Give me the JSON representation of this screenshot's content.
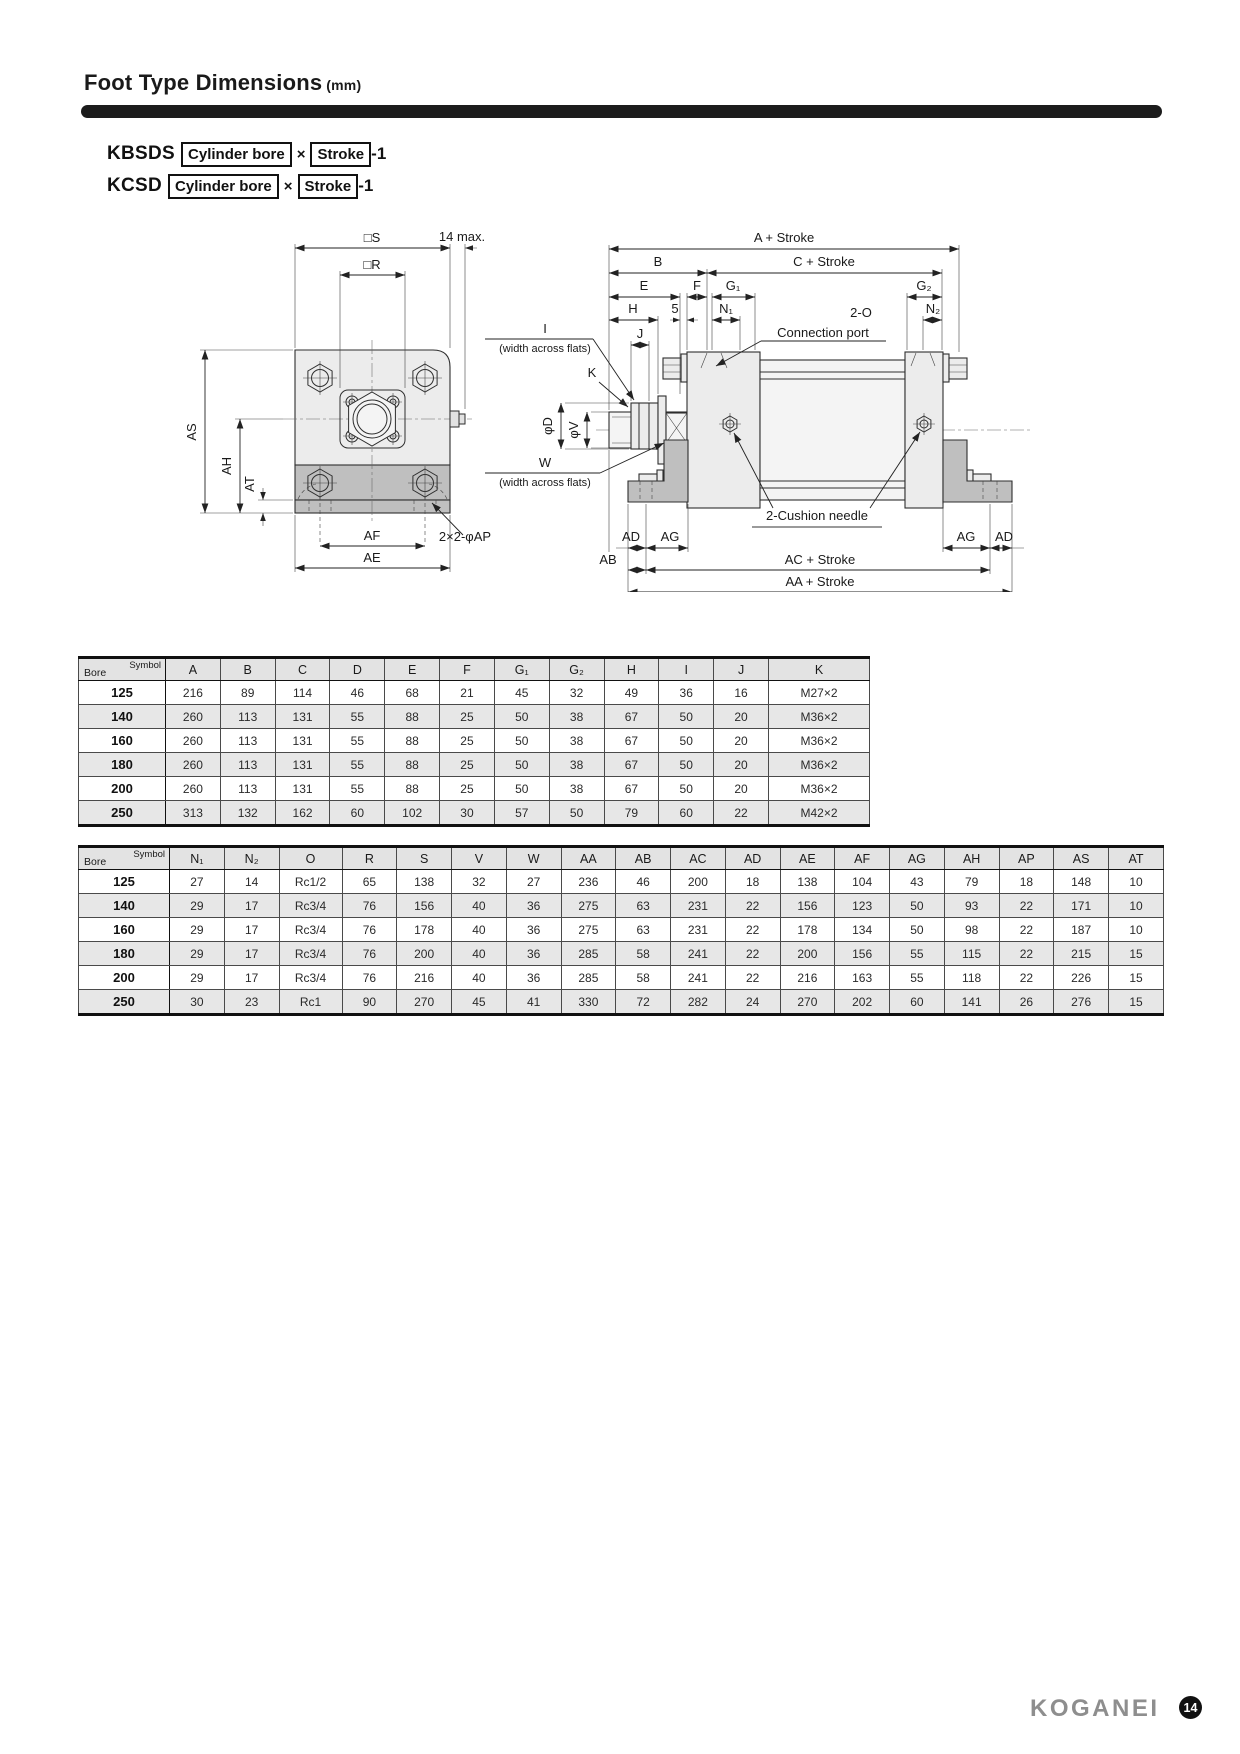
{
  "page": {
    "title": "Foot Type Dimensions",
    "unit": "(mm)"
  },
  "colors": {
    "accent_black": "#1c1c1c",
    "logo_gray": "#8e8e8e",
    "table_shade": "#e7e7e7"
  },
  "models": [
    {
      "code": "KBSDS",
      "box1": "Cylinder bore",
      "times": "×",
      "box2": "Stroke",
      "suffix": "-1"
    },
    {
      "code": "KCSD",
      "box1": "Cylinder bore",
      "times": "×",
      "box2": "Stroke",
      "suffix": "-1"
    }
  ],
  "drawing": {
    "labels": {
      "sq_s": "□S",
      "sq_r": "□R",
      "max14": "14 max.",
      "as": "AS",
      "ah": "AH",
      "at": "AT",
      "af": "AF",
      "ae": "AE",
      "ap": "2×2-φAP",
      "a_stroke": "A + Stroke",
      "b": "B",
      "c_stroke": "C + Stroke",
      "e": "E",
      "f": "F",
      "g1": "G₁",
      "g2": "G₂",
      "h": "H",
      "five": "5",
      "n1": "N₁",
      "n2": "N₂",
      "j": "J",
      "i": "I",
      "waf1": "(width across flats)",
      "k": "K",
      "phi_d": "φD",
      "phi_v": "φV",
      "w": "W",
      "waf2": "(width across flats)",
      "two_o": "2-O",
      "conn_port": "Connection port",
      "cushion": "2-Cushion needle",
      "ad_l": "AD",
      "ag_l": "AG",
      "ab": "AB",
      "ac_stroke": "AC + Stroke",
      "aa_stroke": "AA + Stroke",
      "ag_r": "AG",
      "ad_r": "AD"
    }
  },
  "table1": {
    "corner": {
      "top": "Symbol",
      "bottom": "Bore"
    },
    "headers": [
      "A",
      "B",
      "C",
      "D",
      "E",
      "F",
      "G₁",
      "G₂",
      "H",
      "I",
      "J",
      "K"
    ],
    "rows": [
      {
        "bore": "125",
        "values": [
          "216",
          "89",
          "114",
          "46",
          "68",
          "21",
          "45",
          "32",
          "49",
          "36",
          "16",
          "M27×2"
        ]
      },
      {
        "bore": "140",
        "values": [
          "260",
          "113",
          "131",
          "55",
          "88",
          "25",
          "50",
          "38",
          "67",
          "50",
          "20",
          "M36×2"
        ]
      },
      {
        "bore": "160",
        "values": [
          "260",
          "113",
          "131",
          "55",
          "88",
          "25",
          "50",
          "38",
          "67",
          "50",
          "20",
          "M36×2"
        ]
      },
      {
        "bore": "180",
        "values": [
          "260",
          "113",
          "131",
          "55",
          "88",
          "25",
          "50",
          "38",
          "67",
          "50",
          "20",
          "M36×2"
        ]
      },
      {
        "bore": "200",
        "values": [
          "260",
          "113",
          "131",
          "55",
          "88",
          "25",
          "50",
          "38",
          "67",
          "50",
          "20",
          "M36×2"
        ]
      },
      {
        "bore": "250",
        "values": [
          "313",
          "132",
          "162",
          "60",
          "102",
          "30",
          "57",
          "50",
          "79",
          "60",
          "22",
          "M42×2"
        ]
      }
    ]
  },
  "table2": {
    "corner": {
      "top": "Symbol",
      "bottom": "Bore"
    },
    "headers": [
      "N₁",
      "N₂",
      "O",
      "R",
      "S",
      "V",
      "W",
      "AA",
      "AB",
      "AC",
      "AD",
      "AE",
      "AF",
      "AG",
      "AH",
      "AP",
      "AS",
      "AT"
    ],
    "rows": [
      {
        "bore": "125",
        "values": [
          "27",
          "14",
          "Rc1/2",
          "65",
          "138",
          "32",
          "27",
          "236",
          "46",
          "200",
          "18",
          "138",
          "104",
          "43",
          "79",
          "18",
          "148",
          "10"
        ]
      },
      {
        "bore": "140",
        "values": [
          "29",
          "17",
          "Rc3/4",
          "76",
          "156",
          "40",
          "36",
          "275",
          "63",
          "231",
          "22",
          "156",
          "123",
          "50",
          "93",
          "22",
          "171",
          "10"
        ]
      },
      {
        "bore": "160",
        "values": [
          "29",
          "17",
          "Rc3/4",
          "76",
          "178",
          "40",
          "36",
          "275",
          "63",
          "231",
          "22",
          "178",
          "134",
          "50",
          "98",
          "22",
          "187",
          "10"
        ]
      },
      {
        "bore": "180",
        "values": [
          "29",
          "17",
          "Rc3/4",
          "76",
          "200",
          "40",
          "36",
          "285",
          "58",
          "241",
          "22",
          "200",
          "156",
          "55",
          "115",
          "22",
          "215",
          "15"
        ]
      },
      {
        "bore": "200",
        "values": [
          "29",
          "17",
          "Rc3/4",
          "76",
          "216",
          "40",
          "36",
          "285",
          "58",
          "241",
          "22",
          "216",
          "163",
          "55",
          "118",
          "22",
          "226",
          "15"
        ]
      },
      {
        "bore": "250",
        "values": [
          "30",
          "23",
          "Rc1",
          "90",
          "270",
          "45",
          "41",
          "330",
          "72",
          "282",
          "24",
          "270",
          "202",
          "60",
          "141",
          "26",
          "276",
          "15"
        ]
      }
    ]
  },
  "footer": {
    "logo": "KOGANEI",
    "page_number": "14"
  }
}
